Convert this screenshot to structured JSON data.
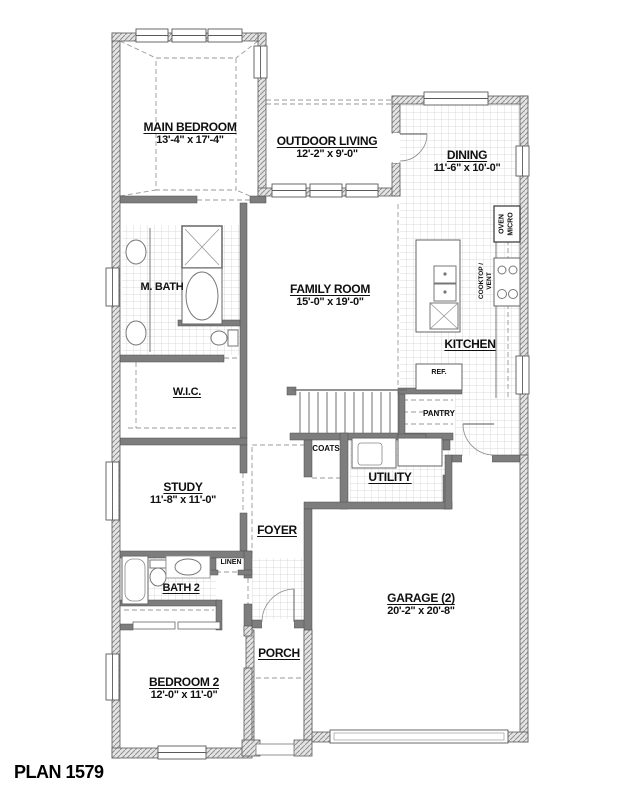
{
  "plan": {
    "title": "PLAN 1579"
  },
  "rooms": {
    "main_bedroom": {
      "name": "MAIN BEDROOM",
      "dims": "13'-4\" x 17'-4\""
    },
    "outdoor_living": {
      "name": "OUTDOOR LIVING",
      "dims": "12'-2\" x 9'-0\""
    },
    "dining": {
      "name": "DINING",
      "dims": "11'-6\" x 10'-0\""
    },
    "family_room": {
      "name": "FAMILY ROOM",
      "dims": "15'-0\" x 19'-0\""
    },
    "kitchen": {
      "name": "KITCHEN"
    },
    "m_bath": {
      "name": "M. BATH"
    },
    "wic": {
      "name": "W.I.C."
    },
    "study": {
      "name": "STUDY",
      "dims": "11'-8\" x 11'-0\""
    },
    "foyer": {
      "name": "FOYER"
    },
    "coats": {
      "name": "COATS"
    },
    "utility": {
      "name": "UTILITY"
    },
    "pantry": {
      "name": "PANTRY"
    },
    "ref": {
      "name": "REF."
    },
    "linen": {
      "name": "LINEN"
    },
    "bath2": {
      "name": "BATH 2"
    },
    "bedroom2": {
      "name": "BEDROOM 2",
      "dims": "12'-0\" x 11'-0\""
    },
    "porch": {
      "name": "PORCH"
    },
    "garage": {
      "name": "GARAGE (2)",
      "dims": "20'-2\" x 20'-8\""
    }
  },
  "appliances": {
    "oven_line1": "OVEN",
    "oven_line2": "MICRO",
    "cooktop_line1": "COOKTOP /",
    "cooktop_line2": "VENT"
  }
}
